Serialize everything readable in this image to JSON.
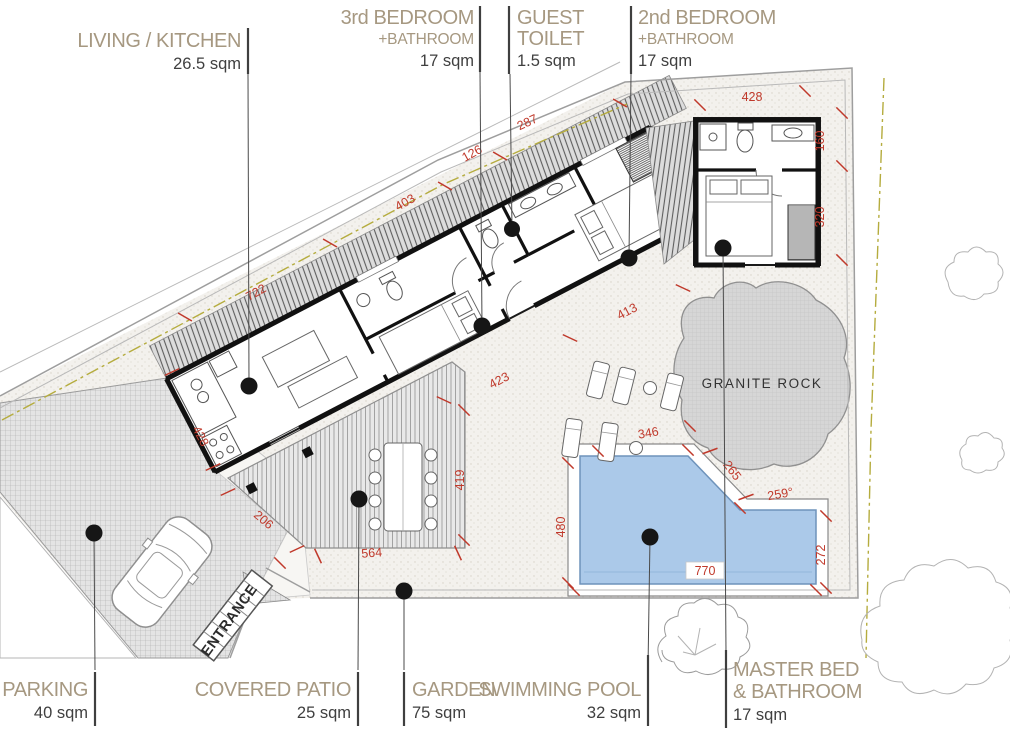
{
  "labels": {
    "top": [
      {
        "title": "LIVING / KITCHEN",
        "area": "26.5 sqm"
      },
      {
        "title": "3rd BEDROOM",
        "subtitle": "+BATHROOM",
        "area": "17 sqm"
      },
      {
        "title": "GUEST",
        "subtitle": "TOILET",
        "area": "1.5 sqm"
      },
      {
        "title": "2nd BEDROOM",
        "subtitle": "+BATHROOM",
        "area": "17 sqm"
      }
    ],
    "bottom": [
      {
        "title": "PARKING",
        "area": "40 sqm"
      },
      {
        "title": "COVERED PATIO",
        "area": "25 sqm"
      },
      {
        "title": "GARDEN",
        "area": "75 sqm"
      },
      {
        "title": "SWIMMING POOL",
        "area": "32 sqm"
      },
      {
        "title": "MASTER BED",
        "subtitle": "& BATHROOM",
        "area": "17 sqm"
      }
    ]
  },
  "plan_texts": {
    "granite_rock": "GRANITE ROCK",
    "entrance": "ENTRANCE"
  },
  "dimensions": [
    "722",
    "403",
    "126",
    "287",
    "428",
    "206",
    "564",
    "419",
    "423",
    "413",
    "346",
    "265",
    "259°",
    "480",
    "770",
    "272",
    "428",
    "160",
    "320"
  ],
  "colors": {
    "title_tan": "#a69881",
    "value_gray": "#3f3f3f",
    "dimension_red": "#c0392b",
    "pool_blue": "#abc9e9",
    "rock_gray": "#d6d6d6",
    "wall_black": "#111111",
    "setback_olive": "#b5ac3e"
  }
}
